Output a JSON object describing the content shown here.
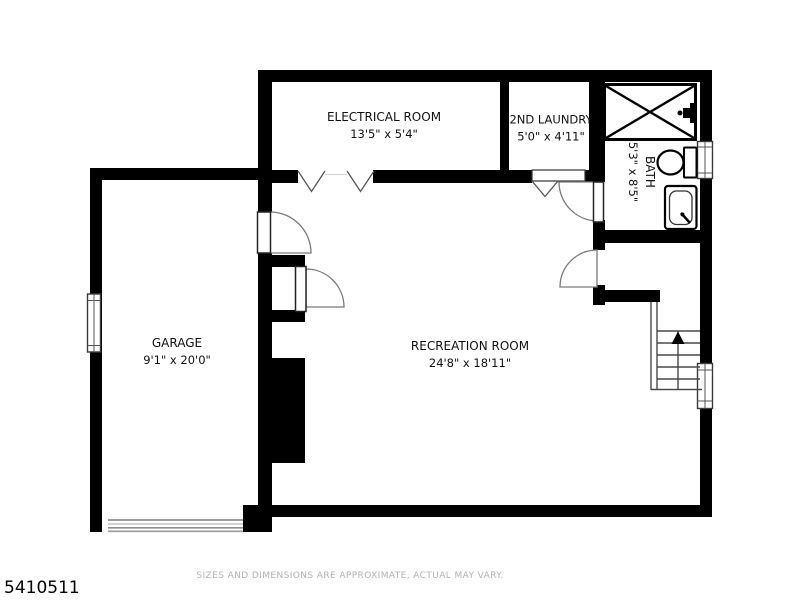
{
  "page": {
    "id_number": "5410511",
    "disclaimer": "SIZES AND DIMENSIONS ARE APPROXIMATE, ACTUAL MAY VARY."
  },
  "rooms": [
    {
      "name": "ELECTRICAL ROOM",
      "dims": "13'5\" x 5'4\""
    },
    {
      "name": "2ND LAUNDRY",
      "dims": "5'0\" x 4'11\""
    },
    {
      "name": "BATH",
      "dims": "5'3\" x 8'5\""
    },
    {
      "name": "GARAGE",
      "dims": "9'1\" x 20'0\""
    },
    {
      "name": "RECREATION ROOM",
      "dims": "24'8\" x 18'11\""
    }
  ],
  "symbols": [
    "shower-stall",
    "shower-valve",
    "toilet",
    "sink-vanity",
    "staircase-with-up-arrow",
    "garage-door",
    "window",
    "door-swing",
    "bifold-door",
    "chimney-mass"
  ],
  "colors": {
    "background": "#ffffff",
    "wall": "#000000",
    "thin_line": "#4a4a4a",
    "door_arc": "#7a7a7a",
    "label_text": "#111111",
    "footer_text": "#b3b3b3"
  }
}
